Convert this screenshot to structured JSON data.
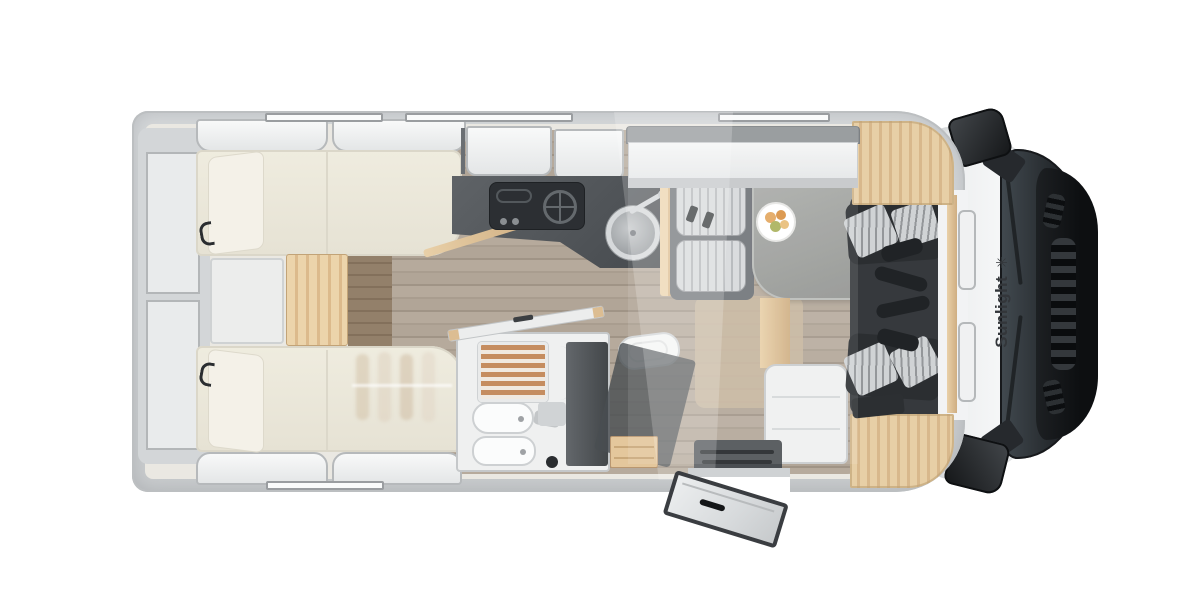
{
  "scene": {
    "description": "Top-down cutaway floor plan render of a Sunlight motorhome",
    "background": "#ffffff"
  },
  "brand": {
    "label": "Sunlight",
    "logo_glyph": "✳"
  },
  "palette": {
    "body_wall": "#cfd2d4",
    "wall_edge": "#9ea1a4",
    "interior_base": "#eae8e2",
    "floor_wood": "#b1a597",
    "bed_cream": "#edeade",
    "oak_light": "#e6cda4",
    "counter_dark": "#54585c",
    "hob_black": "#2b2e31",
    "bench_gray": "#6e7277",
    "cushion_light": "#d2d5d7",
    "table_gray": "#9fa19f",
    "seat_charcoal": "#2b2e31",
    "cab_white": "#f5f6f7",
    "windshield_glass": "#2e3337",
    "hood_black": "#141619",
    "logo_text": "#33363a"
  },
  "areas": {
    "rear_beds": "twin single beds",
    "rear_storage": "rear wall shelves",
    "kitchen": "kitchenette with hob and round sink",
    "bathroom": "washroom with shower, basin and toilet",
    "wardrobe": "wardrobe with drawers",
    "dinette": "half-dinette bench and table",
    "cab_seats": "driver and passenger swivel seats",
    "entry": "entrance door with steps",
    "cab": "driver cab with windshield and mirrors"
  }
}
